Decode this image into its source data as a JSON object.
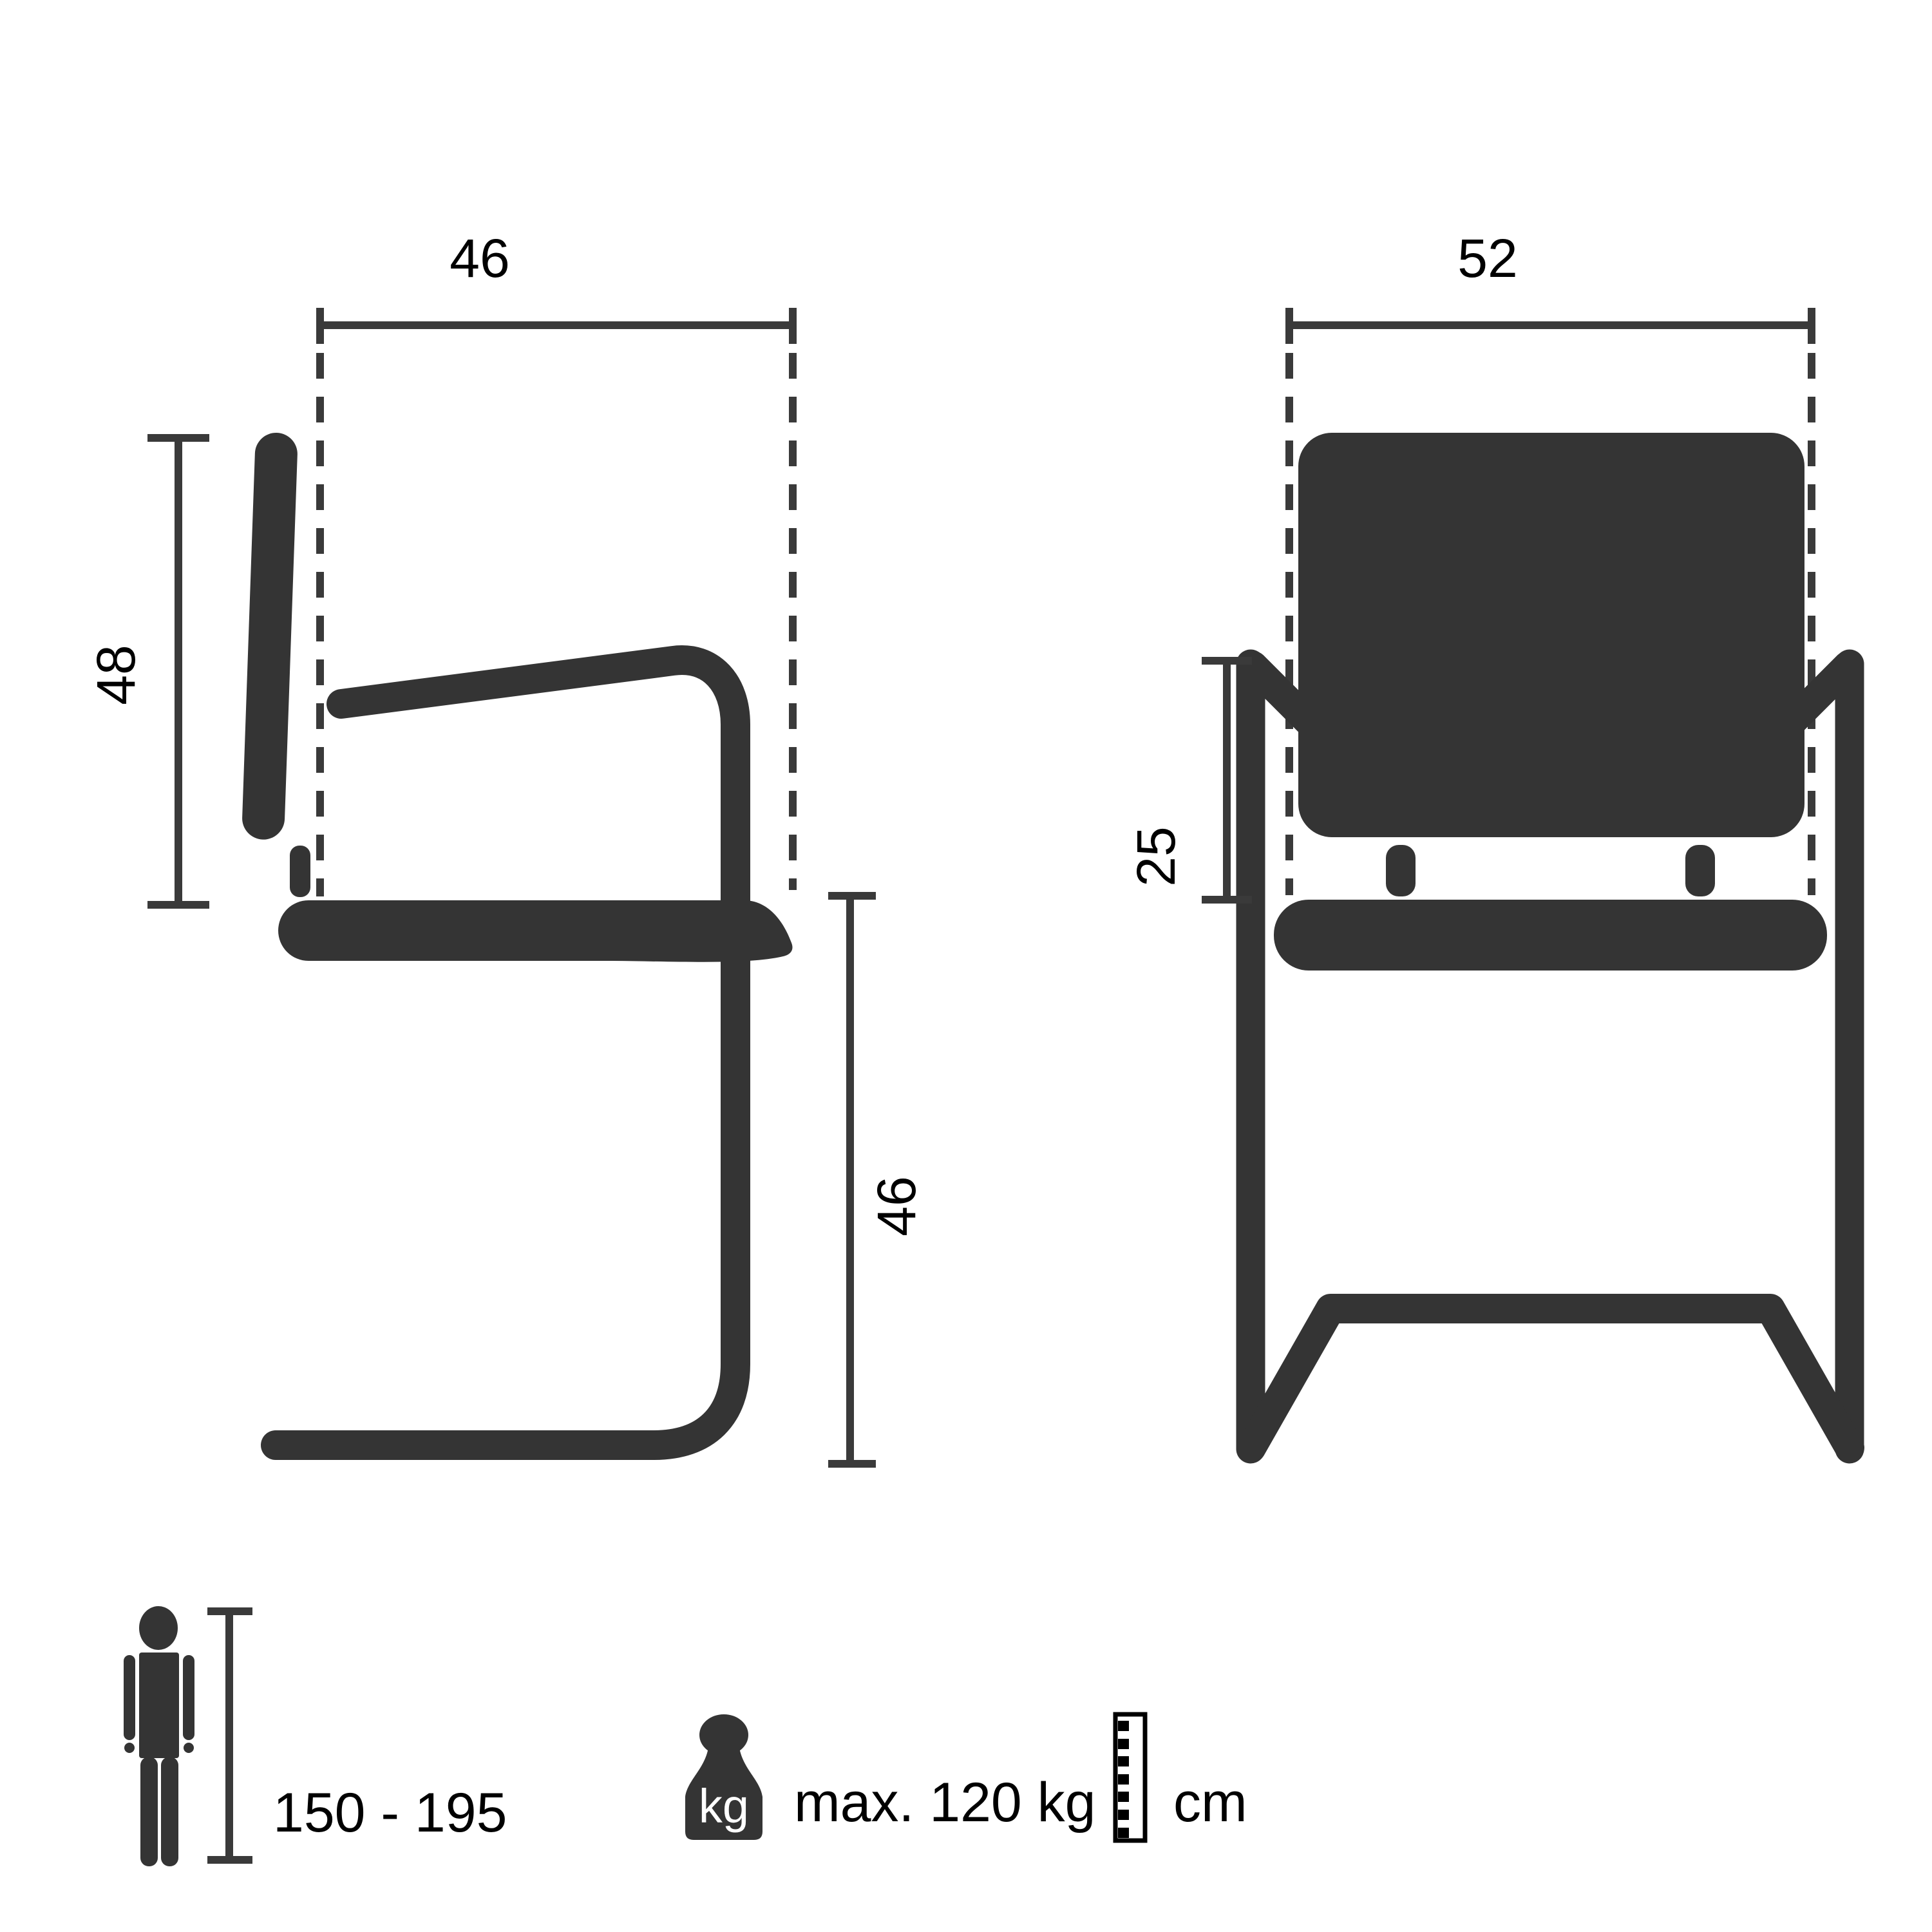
{
  "diagram_type": "product dimension diagram - cantilever chair (side view and front view)",
  "side_view": {
    "top_width_label": "46",
    "back_height_label": "48",
    "seat_height_label": "46"
  },
  "front_view": {
    "width_label": "52",
    "armrest_height_label": "25"
  },
  "legend": {
    "person_height_range": "150 - 195",
    "weight_unit_label": "kg",
    "max_weight": "max. 120 kg",
    "unit_label": "cm"
  },
  "icons": {
    "person": "person-icon",
    "weight": "weight-icon",
    "ruler": "ruler-icon"
  },
  "colors": {
    "graphic": "#343434",
    "dimension": "#3a3a3a",
    "text": "#000000",
    "background": "#ffffff",
    "weight_label": "#ffffff"
  }
}
